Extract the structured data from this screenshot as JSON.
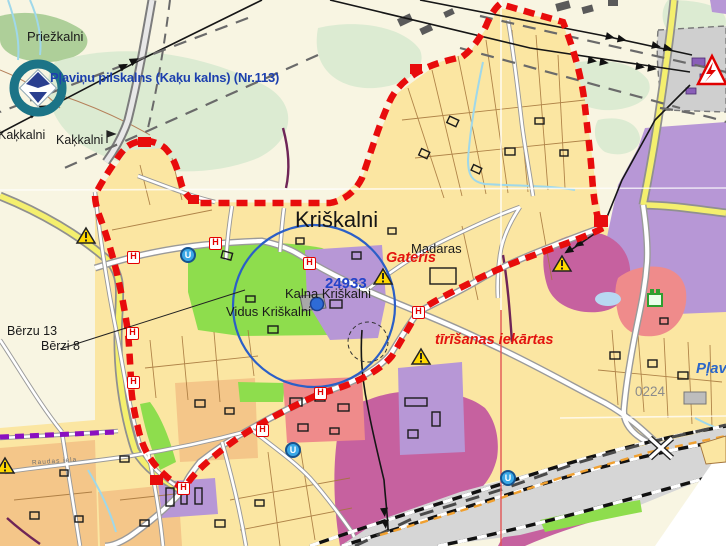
{
  "labels": {
    "priezkalni": "Priežkalni",
    "monument": "Pļaviņu pilskalns (Kaķu kalns) (Nr.113)",
    "kakkalni_left": "Kaķkalni",
    "kakkalni_right": "Kaķkalni",
    "town": "Kriškalni",
    "madaras": "Madaras",
    "gateris": "Gateris",
    "parcel_number": "24933",
    "kalna": "Kalna Kriškalni",
    "vidus": "Vidus Kriškalni",
    "tirisanas": "tīrīšanas iekārtas",
    "berzu13": "Bērzu 13",
    "berzi8": "Bērzi 8",
    "plav": "Pļav",
    "sheet": "0224",
    "street": "Raudas iela"
  },
  "markers": {
    "bus_stop": "H",
    "utility": "U"
  },
  "colors": {
    "boundary_red": "#e80c0c",
    "parcel_yellow": "#fbe6a2",
    "zone_purple": "#b797d6",
    "zone_magenta": "#c6619f",
    "zone_pink": "#ef8b8b",
    "zone_green": "#8edd4d",
    "circle_blue": "#2b5fc7",
    "road_yellow": "#f4ef6e"
  }
}
